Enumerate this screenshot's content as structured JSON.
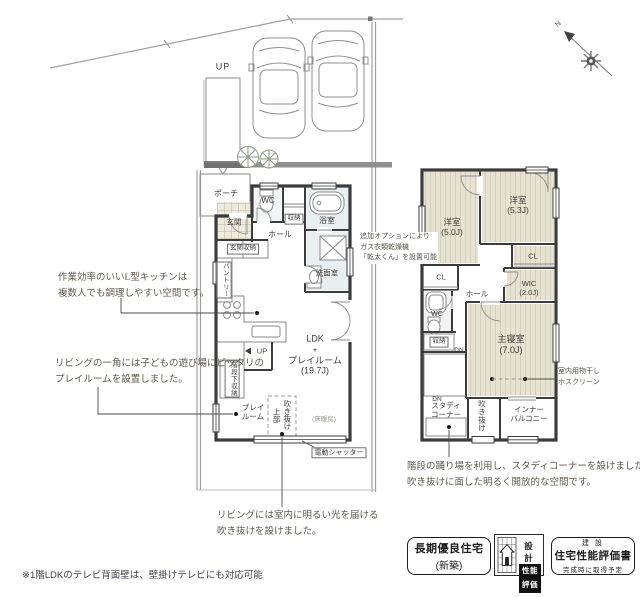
{
  "colors": {
    "wall": "#3c3c3c",
    "tatami": "#e7e3d2",
    "tatami_line": "#d3cfbc",
    "hatch_line": "#b6b0a1",
    "water": "#e9eef0",
    "boundary": "#a0a0a0",
    "note_text": "#5d574d",
    "label_text": "#3e3c38"
  },
  "site": {
    "up_label": "UP",
    "compass_label": "N"
  },
  "floor1": {
    "rooms": {
      "porch": "ポーチ",
      "entrance": "玄関",
      "wc": "WC",
      "storage": "収納",
      "bath": "浴室",
      "washroom": "洗面室",
      "hall": "ホール",
      "entrance_storage": "玄関収納",
      "pantry": "パントリー",
      "stairs_up": "UP",
      "under_stairs_storage": "階段下収納",
      "playroom_line1": "プレイ",
      "playroom_line2": "ルーム",
      "void_upper_col1": "吹き抜け",
      "void_upper_col2": "上部",
      "ldk_line1": "LDK",
      "ldk_line2": "+",
      "ldk_line3": "プレイルーム",
      "ldk_line4": "(19.7J)",
      "floor_heating": "(床暖房)",
      "shutter": "電動シャッター"
    }
  },
  "floor2": {
    "rooms": {
      "bedroom1_name": "洋室",
      "bedroom1_size": "(5.0J)",
      "bedroom2_name": "洋室",
      "bedroom2_size": "(5.3J)",
      "cl1": "CL",
      "cl2": "CL",
      "wic_name": "WIC",
      "wic_size": "(2.0J)",
      "hall": "ホール",
      "wc": "WC",
      "storage": "収納",
      "dn1": "DN",
      "dn2": "DN",
      "master_name": "主寝室",
      "master_size": "(7.0J)",
      "study_line1": "スタディ",
      "study_line2": "コーナー",
      "void": "吹き抜け",
      "balcony_line1": "インナー",
      "balcony_line2": "バルコニー"
    }
  },
  "notes": {
    "kitchen": {
      "line1": "作業効率のいいL型キッチンは",
      "line2": "複数人でも調理しやすい空間です。"
    },
    "playroom": {
      "line1": "リビングの一角には子どもの遊び場にピッタリの",
      "line2": "プレイルームを設置しました。"
    },
    "dryer": {
      "line1": "追加オプションにより",
      "line2": "ガス衣類乾燥機",
      "line3": "「乾太くん」を設置可能"
    },
    "hosclean": {
      "line1": "室内用物干し",
      "line2": "ホスクリーン"
    },
    "void": {
      "line1": "リビングには室内に明るい光を届ける",
      "line2": "吹き抜けを設けました。"
    },
    "study": {
      "line1": "階段の踊り場を利用し、スタディコーナーを設けました。",
      "line2": "吹き抜けに面した明るく開放的な空間です。"
    },
    "footnote": "※1階LDKのテレビ背面壁は、壁掛けテレビにも対応可能"
  },
  "badges": {
    "long_term": {
      "line1": "長期優良住宅",
      "line2": "(新築)"
    },
    "design_eval": {
      "top": "設 計",
      "bottom": "性能評価"
    },
    "construction_eval": {
      "line1": "建 設",
      "line2": "住宅性能評価書",
      "line3": "完成時に取得予定"
    }
  }
}
